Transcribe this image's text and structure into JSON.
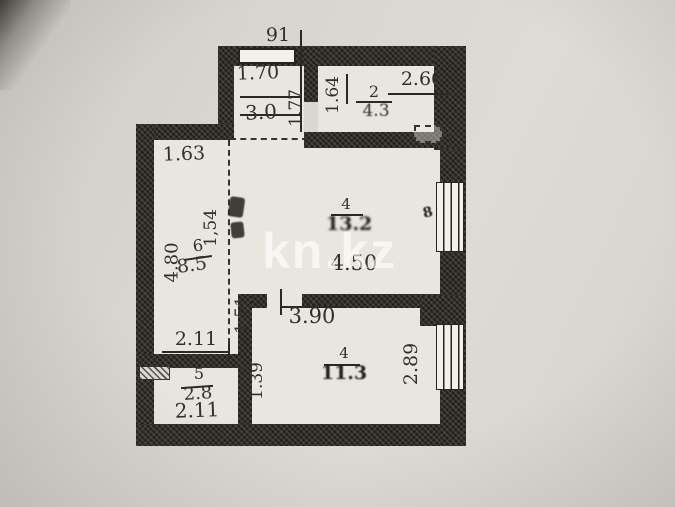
{
  "watermark": "kn.kz",
  "dims": {
    "top_offset": "91",
    "vestibule_width": "1.70",
    "vestibule_height": "1.77",
    "room2_width": "2.66",
    "room2_height": "1.64",
    "room6_width": "1.63",
    "room6_height": "4.80",
    "center_left_upper": "1,54",
    "center_left_lower": "1.51",
    "center_width": "4.50",
    "room4_width": "3.90",
    "room4_height": "2.89",
    "room5_width": "2.11",
    "room5_height": "1.39",
    "bottom_width": "2.11"
  },
  "rooms": {
    "vestibule": {
      "area": "3.0"
    },
    "room2": {
      "number": "2",
      "area": "4.3"
    },
    "room6": {
      "number": "6",
      "area": "8.5"
    },
    "center": {
      "number": "4",
      "area": "13.2",
      "side_mark": "8"
    },
    "room4": {
      "number": "4",
      "area": "11.3"
    },
    "room5": {
      "number": "5",
      "area": "2.8"
    }
  }
}
